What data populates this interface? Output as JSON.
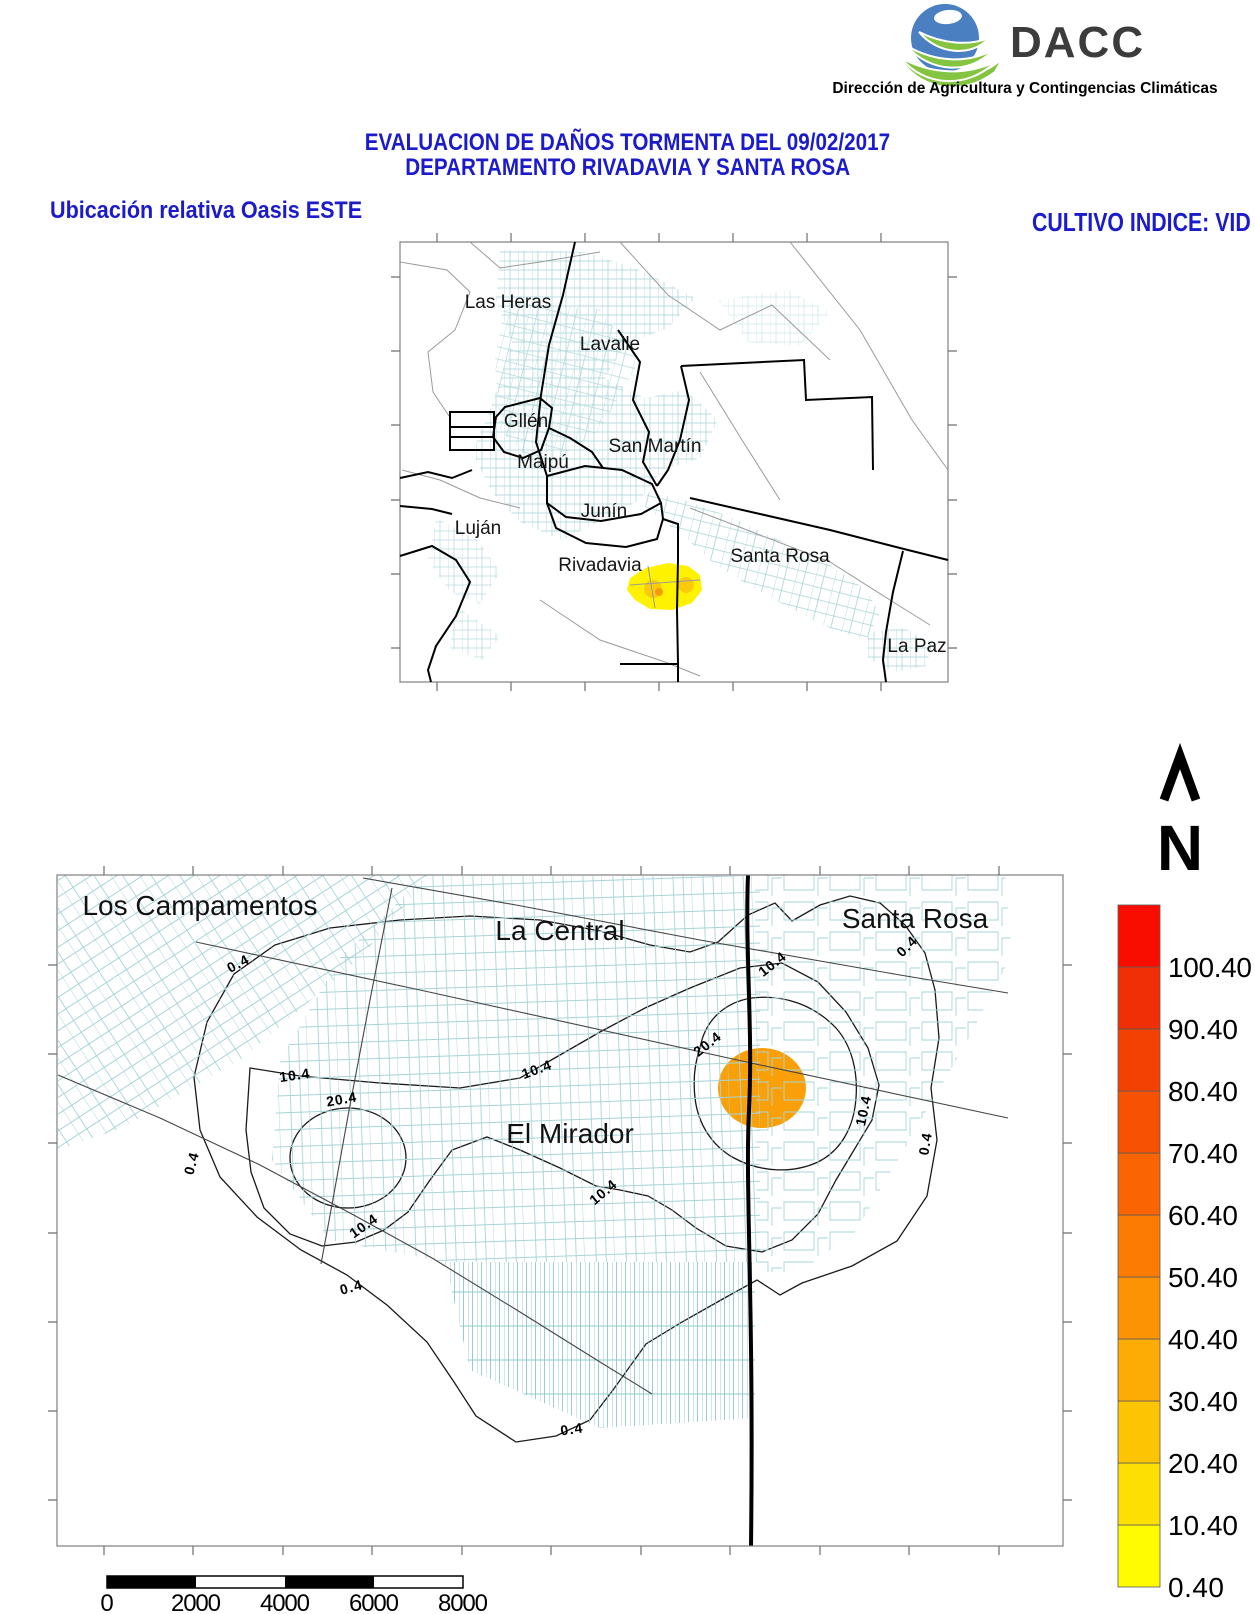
{
  "header": {
    "logo_text": "DACC",
    "logo_subtitle": "Dirección de Agricultura y Contingencias Climáticas",
    "title_line1": "EVALUACION DE DAÑOS TORMENTA DEL 09/02/2017",
    "title_line2": "DEPARTAMENTO RIVADAVIA Y SANTA ROSA",
    "left_caption": "Ubicación relativa Oasis ESTE",
    "right_caption": "CULTIVO INDICE: VID",
    "title_color": "#1B1BCB",
    "logo_colors": {
      "globe": "#4A80C2",
      "leaf": "#85C440",
      "text": "#3C3C3C"
    }
  },
  "locator_map": {
    "labels": [
      "Las Heras",
      "Lavalle",
      "Gllén",
      "Maipú",
      "San Martín",
      "Junín",
      "Luján",
      "Rivadavia",
      "Santa Rosa",
      "La Paz"
    ],
    "highlight_fill": "#FFF200",
    "highlight_spot_fill": "#FBCB0A",
    "highlight_core_fill": "#F59B07",
    "parcel_color": "#A7D4D8",
    "road_color": "#9A9A9A",
    "boundary_color": "#000000"
  },
  "damage_map": {
    "places": [
      "Los Campamentos",
      "La Central",
      "Santa Rosa",
      "El Mirador"
    ],
    "levels": [
      "0.4",
      "10.4",
      "20.4"
    ],
    "zone_fills": {
      "z0": "#FFF903",
      "z1": "#FEDD04",
      "z2": "#FBB216",
      "z3": "#F9A009"
    },
    "boundary_color": "#000000",
    "parcel_color": "#A7D4D8"
  },
  "north_arrow": {
    "label": "N"
  },
  "legend": {
    "entries": [
      {
        "label": "0.40",
        "color": "#FFFC01"
      },
      {
        "label": "10.40",
        "color": "#FEDF03"
      },
      {
        "label": "20.40",
        "color": "#FDC404"
      },
      {
        "label": "30.40",
        "color": "#FDAC05"
      },
      {
        "label": "40.40",
        "color": "#FC9304"
      },
      {
        "label": "50.40",
        "color": "#FB7B03"
      },
      {
        "label": "60.40",
        "color": "#FA6403"
      },
      {
        "label": "70.40",
        "color": "#F75203"
      },
      {
        "label": "80.40",
        "color": "#F34104"
      },
      {
        "label": "90.40",
        "color": "#F02F06"
      },
      {
        "label": "100.40",
        "color": "#F90D01"
      }
    ]
  },
  "scale_bar": {
    "tick_labels": [
      "0",
      "2000",
      "4000",
      "6000",
      "8000"
    ]
  }
}
